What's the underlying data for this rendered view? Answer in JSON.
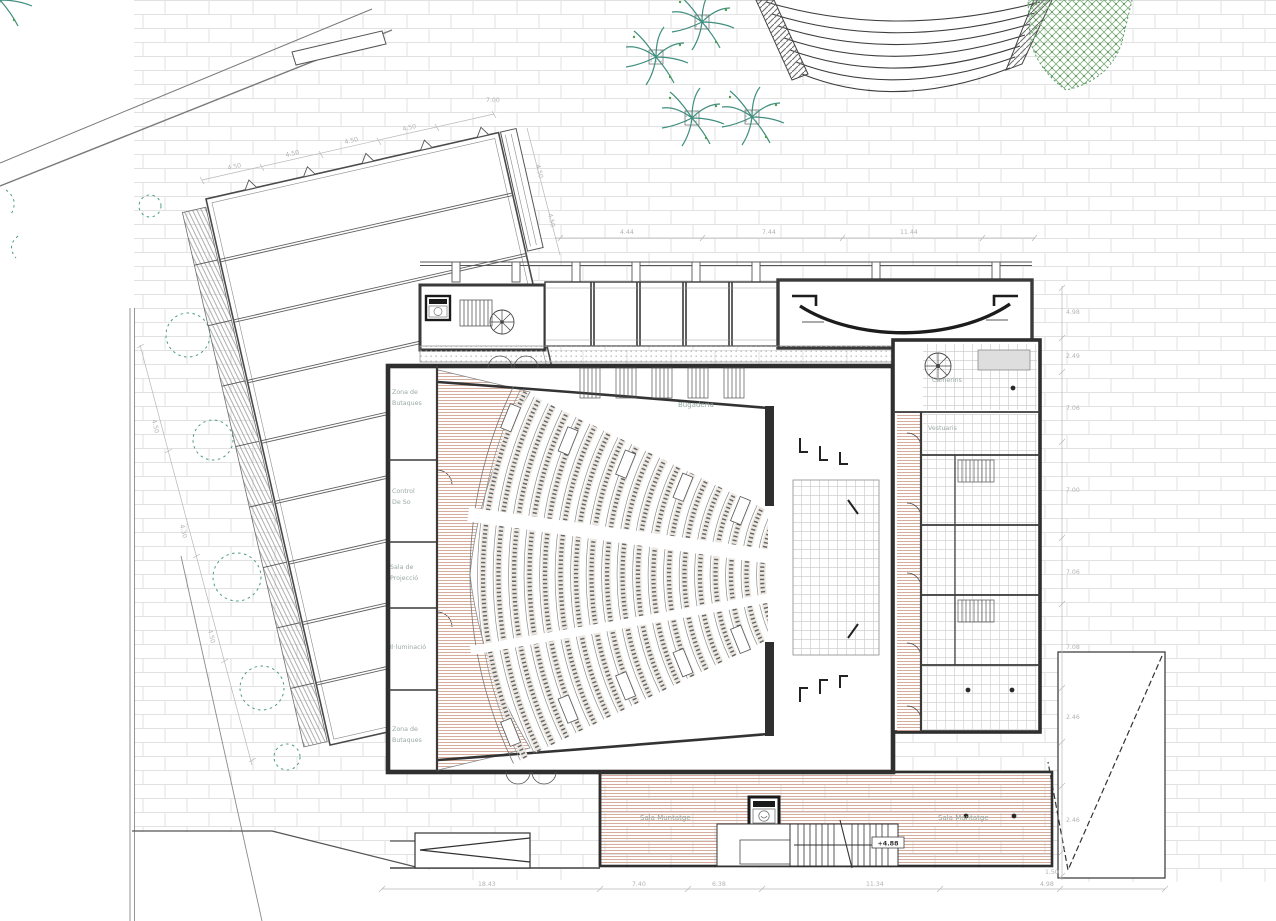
{
  "drawing": {
    "kind": "theatre-ground-floor-plan",
    "labels": {
      "zona_top": {
        "l1": "Zona de",
        "l2": "Butaques"
      },
      "control": {
        "l1": "Control",
        "l2": "De So"
      },
      "projeccio": {
        "l1": "Sala de",
        "l2": "Projecció"
      },
      "illuminacio": "Il·luminació",
      "zona_bottom": {
        "l1": "Zona de",
        "l2": "Butaques"
      },
      "bugaderia": "Bugaderia",
      "camerins": "Camerins",
      "vestuaris": "Vestuaris",
      "sala_left": "Sala Muntatge",
      "sala_right": "Sala Muntatge"
    },
    "levels": {
      "stair_landing": "+4.88"
    },
    "dims": {
      "top_chain": [
        "4.50",
        "4.50",
        "4.50",
        "4.50"
      ],
      "top_apex": "7.00",
      "left_chain": [
        "4.50",
        "4.30",
        "4.50"
      ],
      "side_chain": [
        "4.50",
        "4.50"
      ],
      "plaza_chain": [
        "4.44",
        "7.44",
        "11.44"
      ],
      "right_chain": [
        "4.98",
        "2.49",
        "7.06",
        "7.00",
        "7.06",
        "7.08",
        "2.46",
        "2.46",
        "1.50"
      ],
      "bottom_chain": [
        "18.43",
        "7.40",
        "6.38",
        "11.34",
        "4.98"
      ]
    },
    "colors": {
      "wall": "#3a3a3a",
      "paving_line": "#e2e2e2",
      "aisle_hatch": "#cf9f8d",
      "vegetation": "#3f8e7e",
      "tile_line": "#cfcfcf",
      "label_text": "#93a69e",
      "dim_text": "#b3b3b3"
    }
  }
}
